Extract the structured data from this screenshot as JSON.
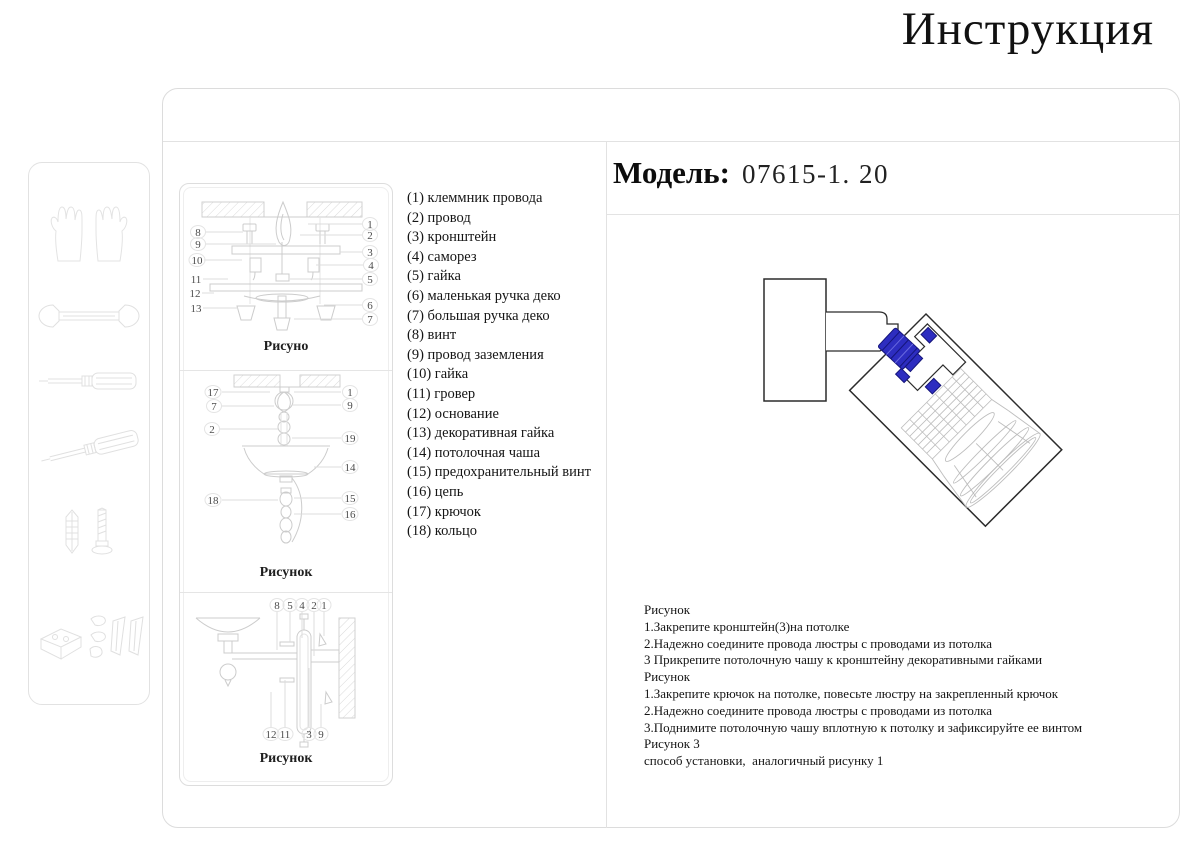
{
  "page": {
    "title": "Инструкция"
  },
  "model": {
    "label": "Модель:",
    "value": "07615-1. 20"
  },
  "colors": {
    "accent_blue": "#2d2dc0",
    "drawing_line_gray": "#c9c9c9",
    "border_gray": "#dddddd",
    "dark_stroke": "#2b2b2b"
  },
  "sidebar": {
    "icons": [
      "gloves-icon",
      "wrench-icon",
      "screwdriver-icon",
      "screwdriver-angled-icon",
      "screw-and-dowel-icon",
      "mounting-hardware-icon"
    ]
  },
  "parts_list": [
    "(1) клеммник провода",
    "(2) провод",
    "(3) кронштейн",
    "(4) саморез",
    "(5) гайка",
    "(6) маленькая ручка деко",
    "(7) большая ручка деко",
    "(8) винт",
    "(9) провод заземления",
    "(10) гайка",
    "(11) гровер",
    "(12) основание",
    "(13) декоративная гайка",
    "(14) потолочная чаша",
    "(15) предохранительный винт",
    "(16) цепь",
    "(17) крючок",
    "(18) кольцо"
  ],
  "figures": [
    {
      "caption": "Рисуно",
      "left": [
        "8",
        "9",
        "10",
        "11",
        "12",
        "13"
      ],
      "right": [
        "1",
        "2",
        "3",
        "4",
        "5",
        "6",
        "7"
      ]
    },
    {
      "caption": "Рисунок",
      "left": [
        "17",
        "7",
        "2",
        "18"
      ],
      "right": [
        "1",
        "9",
        "19",
        "14",
        "15",
        "16"
      ]
    },
    {
      "caption": "Рисунок",
      "top": [
        "8",
        "5",
        "4",
        "2",
        "1"
      ],
      "bottom": [
        "12",
        "11",
        "3",
        "9"
      ]
    }
  ],
  "instructions": {
    "lines": [
      "Рисунок",
      "1.Закрепите кронштейн(3)на потолке",
      "2.Надежно соедините провода люстры с проводами из потолка",
      "3 Прикрепите потолочную чашу к кронштейну декоративными гайками",
      "Рисунок",
      "1.Закрепите крючок на потолке, повесьте люстру на закрепленный крючок",
      "2.Надежно соедините провода люстры с проводами из потолка",
      "3.Поднимите потолочную чашу вплотную к потолку и зафиксируйте ее винтом",
      "Рисунок 3",
      "способ установки,  аналогичный рисунку 1"
    ]
  }
}
